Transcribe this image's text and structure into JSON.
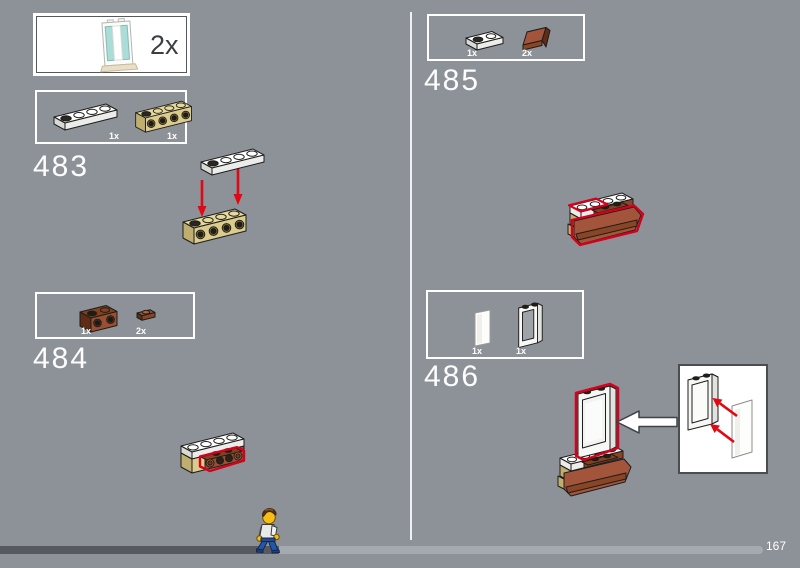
{
  "multiplier_box": {
    "count": "2x",
    "piece": "white-door-frame-1x4x6-with-trans-light-blue-panes-on-tan-plate"
  },
  "steps": [
    {
      "number": "483",
      "parts": [
        {
          "count": "1x",
          "piece": "white-plate-1x4"
        },
        {
          "count": "1x",
          "piece": "tan-brick-1x4-with-four-side-holes"
        }
      ],
      "diagram": "white plate 1x4 lowered onto tan brick 1x4 with two red arrows"
    },
    {
      "number": "484",
      "parts": [
        {
          "count": "1x",
          "piece": "reddish-brown-brick-1x2-with-holes"
        },
        {
          "count": "2x",
          "piece": "reddish-brown-plate-1x1"
        }
      ],
      "diagram": "reddish-brown brick and plates attached to side of assembly, new parts outlined in red"
    },
    {
      "number": "485",
      "parts": [
        {
          "count": "1x",
          "piece": "white-plate-1x2"
        },
        {
          "count": "2x",
          "piece": "reddish-brown-slope-1x2"
        }
      ],
      "diagram": "white plate and reddish-brown slopes added to assembly, new parts outlined in red"
    },
    {
      "number": "486",
      "parts": [
        {
          "count": "1x",
          "piece": "trans-clear-glass-panel"
        },
        {
          "count": "1x",
          "piece": "white-window-frame-1x2x2"
        }
      ],
      "diagram": "window frame placed on assembly; callout shows glass panel inserted into frame with red arrows"
    }
  ],
  "footer": {
    "page_number": "167",
    "progress_percent": 35
  },
  "colors": {
    "background": "#8d9299",
    "highlight_red": "#d6001c",
    "arrow_red": "#e30613",
    "progress_filled": "#56595f",
    "progress_remaining": "#a4aab0",
    "tan": "#dbcb8c",
    "reddish_brown": "#9a5030",
    "white_piece": "#ffffff",
    "trans_light_blue": "#abdcd7"
  }
}
